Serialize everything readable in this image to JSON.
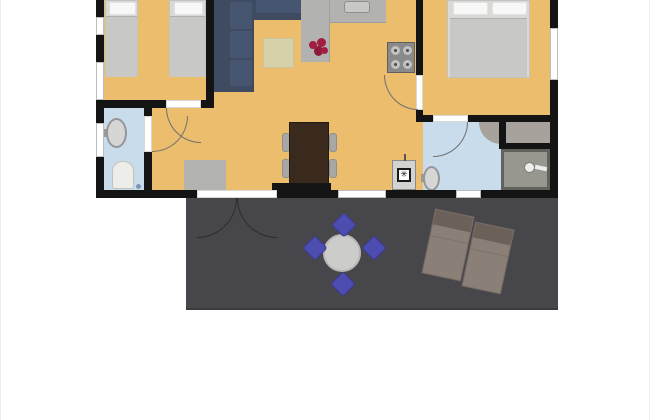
{
  "scene": {
    "type": "2d-floor-plan",
    "description": "Top-down floor plan of a holiday apartment: two bedrooms, living room with open kitchen, two bathrooms, closet, and a large dark terrace with outdoor furniture. Plan is cropped at the top edge of the image. No text labels are rendered.",
    "visible_text": []
  },
  "colors": {
    "floor": "#edbd6e",
    "wall": "#141414",
    "bath_floor": "#c8dcec",
    "counter": "#b2b2b0",
    "counter_sink": "#c8c8c6",
    "sofa": "#3e4b61",
    "sofa_cushion": "#475670",
    "bed_base": "#d9d9d7",
    "bed_blanket": "#c8c8c6",
    "pillow": "#f7f7f7",
    "rug_beige": "#d7d1a9",
    "rug_gray": "#b3b3af",
    "table_wood": "#3a2a1d",
    "chair_gray": "#a7a7a5",
    "flower_red": "#a21f42",
    "stove": "#8a8a8b",
    "burner": "#c2c2c0",
    "appliance": "#d3d3d1",
    "deck": "#47474b",
    "patio_table": "#cccccb",
    "patio_chair": "#4d4db0",
    "lounger": "#8a8078",
    "lounger_head": "#6b6159",
    "shower": "#97978f",
    "shower_border": "#62625c",
    "closet": "#a7a29b",
    "fixture": "#ededeb",
    "porcelain": "#edede9",
    "drain": "#7f98b5",
    "arc": "#707070",
    "window_frame": "#bdbdbd",
    "console_black": "#151515"
  },
  "rooms": [
    {
      "id": "bedroom-1",
      "label": "Bedroom 1",
      "furniture": [
        "twin bed left",
        "twin bed right"
      ]
    },
    {
      "id": "living-kitchen",
      "label": "Living room / open kitchen",
      "furniture": [
        "corner sofa",
        "beige rug",
        "kitchen counter with sink",
        "stove with 4 burners",
        "red flowers",
        "dining table",
        "4 gray chairs",
        "black sideboard",
        "washing machine",
        "gray hall rug"
      ]
    },
    {
      "id": "bedroom-2",
      "label": "Bedroom 2",
      "furniture": [
        "double bed with two pillows"
      ]
    },
    {
      "id": "bathroom-1",
      "label": "Bathroom 1",
      "furniture": [
        "wash basin",
        "toilet",
        "floor drain"
      ]
    },
    {
      "id": "bathroom-2",
      "label": "Bathroom 2",
      "furniture": [
        "wash basin",
        "corner shelf",
        "shower with shower head"
      ]
    },
    {
      "id": "closet",
      "label": "Closet",
      "furniture": []
    },
    {
      "id": "terrace",
      "label": "Terrace",
      "furniture": [
        "round patio table",
        "4 blue patio chairs",
        "2 sun loungers"
      ]
    }
  ],
  "symbols": {
    "washing_machine_symbol": "✳"
  }
}
